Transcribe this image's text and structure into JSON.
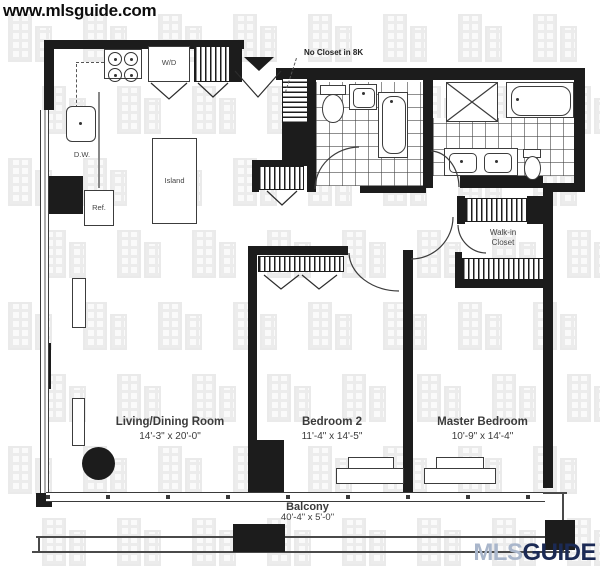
{
  "site_watermark": "www.mlsguide.com",
  "brand": {
    "mls": "MLS",
    "guide": "GUIDE",
    "mls_color": "#a9b6cb",
    "guide_color": "#1b2a55"
  },
  "annotation": {
    "no_closet_note": "No Closet in 8K"
  },
  "rooms": {
    "living": {
      "name": "Living/Dining Room",
      "dims": "14'-3\" x 20'-0\""
    },
    "bedroom2": {
      "name": "Bedroom 2",
      "dims": "11'-4\" x 14'-5\""
    },
    "master": {
      "name": "Master Bedroom",
      "dims": "10'-9\" x 14'-4\""
    },
    "balcony": {
      "name": "Balcony",
      "dims": "40'-4\" x 5'-0\""
    },
    "walkin": {
      "line1": "Walk-in",
      "line2": "Closet"
    }
  },
  "fixtures": {
    "wd": "W/D",
    "dw": "D.W.",
    "ref": "Ref.",
    "island": "Island"
  },
  "colors": {
    "wall": "#1c1c1c",
    "fixture_line": "#3c3c3c",
    "watermark_building": "#ececec"
  }
}
